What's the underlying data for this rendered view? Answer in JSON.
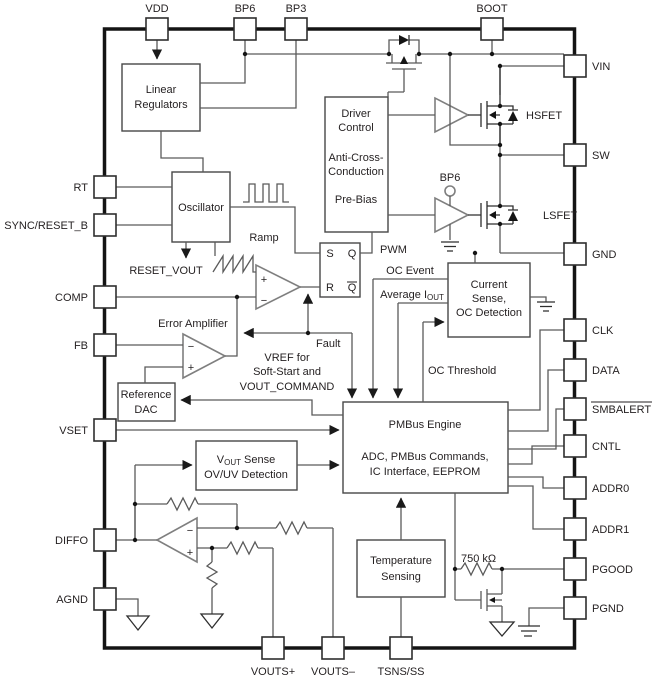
{
  "diagram_type": "ic-functional-block-diagram",
  "pins": {
    "vdd": "VDD",
    "bp6": "BP6",
    "bp3": "BP3",
    "boot": "BOOT",
    "rt": "RT",
    "sync_reset_b": "SYNC/RESET_B",
    "comp": "COMP",
    "fb": "FB",
    "vset": "VSET",
    "diffo": "DIFFO",
    "agnd": "AGND",
    "vin": "VIN",
    "sw": "SW",
    "gnd": "GND",
    "clk": "CLK",
    "data": "DATA",
    "smbalert": "SMBALERT",
    "cntl": "CNTL",
    "addr0": "ADDR0",
    "addr1": "ADDR1",
    "pgood": "PGOOD",
    "pgnd": "PGND",
    "vouts_plus": "VOUTS+",
    "vouts_minus": "VOUTS–",
    "tsns_ss": "TSNS/SS"
  },
  "blocks": {
    "linear_regulators": {
      "line1": "Linear",
      "line2": "Regulators"
    },
    "oscillator": {
      "label": "Oscillator"
    },
    "driver_control": {
      "line1": "Driver",
      "line2": "Control",
      "line3": "Anti-Cross-",
      "line4": "Conduction",
      "line5": "Pre-Bias"
    },
    "latch": {
      "s": "S",
      "q": "Q",
      "r": "R",
      "qbar": "Q"
    },
    "current_sense": {
      "line1": "Current",
      "line2": "Sense,",
      "line3": "OC Detection"
    },
    "reference_dac": {
      "line1": "Reference",
      "line2": "DAC"
    },
    "pmbus": {
      "line1": "PMBus Engine",
      "line2": "ADC, PMBus Commands,",
      "line3": "IC Interface, EEPROM"
    },
    "vout_sense": {
      "v": "V",
      "sub": "OUT",
      "rest": " Sense",
      "line2": "OV/UV Detection"
    },
    "temp_sensing": {
      "line1": "Temperature",
      "line2": "Sensing"
    }
  },
  "labels": {
    "pwm": "PWM",
    "ramp": "Ramp",
    "reset_vout": "RESET_VOUT",
    "fault": "Fault",
    "oc_event": "OC Event",
    "avg_i": "Average I",
    "avg_i_sub": "OUT",
    "oc_threshold": "OC Threshold",
    "error_amplifier": "Error Amplifier",
    "vref1": "VREF for",
    "vref2": "Soft-Start and",
    "vref3": "VOUT_COMMAND",
    "hsfet": "HSFET",
    "lsfet": "LSFET",
    "bp6_rail": "BP6",
    "pullup": "750 kΩ",
    "plus": "+",
    "minus": "−"
  },
  "colors": {
    "background": "#ffffff",
    "ink": "#231f20",
    "wire": "#5a5a5a",
    "border": "#141414"
  }
}
